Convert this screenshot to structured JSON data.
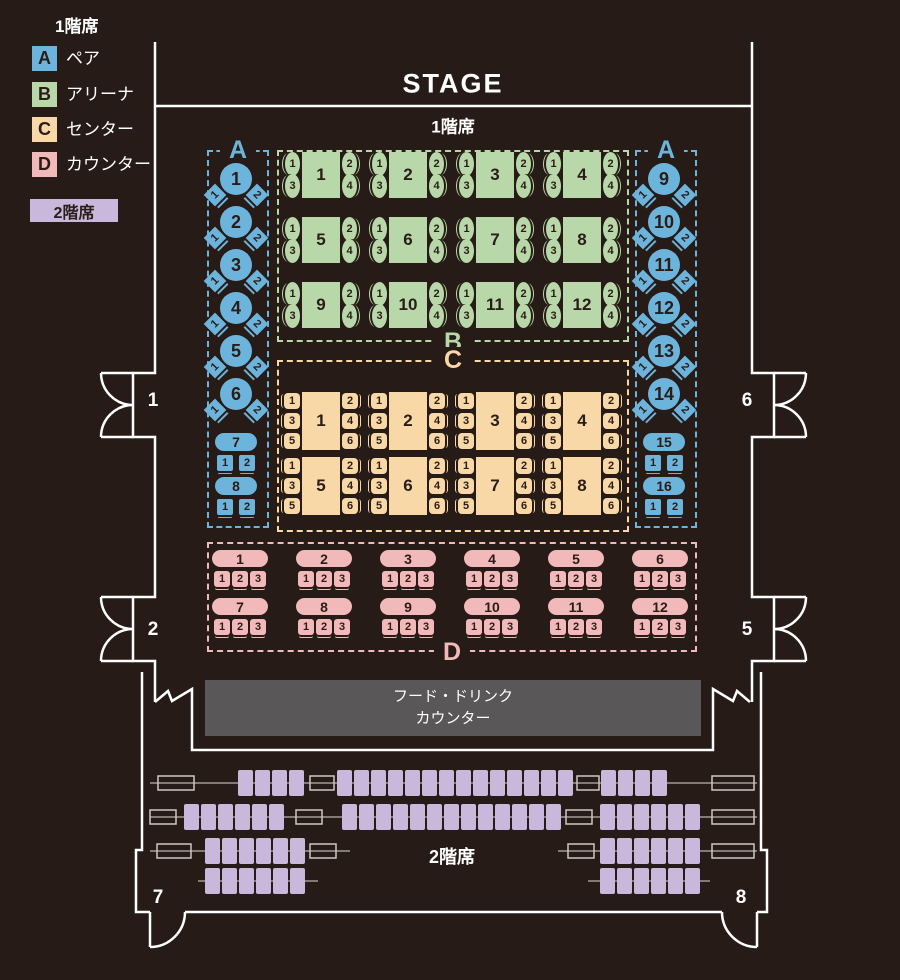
{
  "colors": {
    "bg": "#261b16",
    "blue": "#6db4dc",
    "green": "#b9d8a9",
    "orange": "#f8d8a6",
    "pink": "#f2b9ba",
    "purple": "#c9b7dc",
    "counter_gray": "#595757",
    "wall": "#ffffff",
    "ink": "#2a1c16"
  },
  "legend": {
    "floor1_title": "1階席",
    "items": [
      {
        "key": "A",
        "label": "ペア"
      },
      {
        "key": "B",
        "label": "アリーナ"
      },
      {
        "key": "C",
        "label": "センター"
      },
      {
        "key": "D",
        "label": "カウンター"
      }
    ],
    "floor2_title": "2階席"
  },
  "stage_label": "STAGE",
  "floor1_label": "1階席",
  "floor2_label": "2階席",
  "counter": {
    "line1": "フード・ドリンク",
    "line2": "カウンター"
  },
  "door_labels": [
    "1",
    "2",
    "5",
    "6",
    "7",
    "8"
  ],
  "sections": {
    "a_left": {
      "label": "A",
      "round_tables": [
        {
          "n": "1",
          "seats": [
            "1",
            "2"
          ]
        },
        {
          "n": "2",
          "seats": [
            "1",
            "2"
          ]
        },
        {
          "n": "3",
          "seats": [
            "1",
            "2"
          ]
        },
        {
          "n": "4",
          "seats": [
            "1",
            "2"
          ]
        },
        {
          "n": "5",
          "seats": [
            "1",
            "2"
          ]
        },
        {
          "n": "6",
          "seats": [
            "1",
            "2"
          ]
        }
      ],
      "pill_tables": [
        {
          "n": "7",
          "seats": [
            "1",
            "2"
          ]
        },
        {
          "n": "8",
          "seats": [
            "1",
            "2"
          ]
        }
      ]
    },
    "a_right": {
      "label": "A",
      "round_tables": [
        {
          "n": "9",
          "seats": [
            "1",
            "2"
          ]
        },
        {
          "n": "10",
          "seats": [
            "1",
            "2"
          ]
        },
        {
          "n": "11",
          "seats": [
            "1",
            "2"
          ]
        },
        {
          "n": "12",
          "seats": [
            "1",
            "2"
          ]
        },
        {
          "n": "13",
          "seats": [
            "1",
            "2"
          ]
        },
        {
          "n": "14",
          "seats": [
            "1",
            "2"
          ]
        }
      ],
      "pill_tables": [
        {
          "n": "15",
          "seats": [
            "1",
            "2"
          ]
        },
        {
          "n": "16",
          "seats": [
            "1",
            "2"
          ]
        }
      ]
    },
    "b": {
      "label": "B",
      "tables": [
        {
          "n": "1",
          "seats": [
            "1",
            "2",
            "3",
            "4"
          ]
        },
        {
          "n": "2",
          "seats": [
            "1",
            "2",
            "3",
            "4"
          ]
        },
        {
          "n": "3",
          "seats": [
            "1",
            "2",
            "3",
            "4"
          ]
        },
        {
          "n": "4",
          "seats": [
            "1",
            "2",
            "3",
            "4"
          ]
        },
        {
          "n": "5",
          "seats": [
            "1",
            "2",
            "3",
            "4"
          ]
        },
        {
          "n": "6",
          "seats": [
            "1",
            "2",
            "3",
            "4"
          ]
        },
        {
          "n": "7",
          "seats": [
            "1",
            "2",
            "3",
            "4"
          ]
        },
        {
          "n": "8",
          "seats": [
            "1",
            "2",
            "3",
            "4"
          ]
        },
        {
          "n": "9",
          "seats": [
            "1",
            "2",
            "3",
            "4"
          ]
        },
        {
          "n": "10",
          "seats": [
            "1",
            "2",
            "3",
            "4"
          ]
        },
        {
          "n": "11",
          "seats": [
            "1",
            "2",
            "3",
            "4"
          ]
        },
        {
          "n": "12",
          "seats": [
            "1",
            "2",
            "3",
            "4"
          ]
        }
      ]
    },
    "c": {
      "label": "C",
      "tables": [
        {
          "n": "1",
          "seats": [
            "1",
            "2",
            "3",
            "4",
            "5",
            "6"
          ]
        },
        {
          "n": "2",
          "seats": [
            "1",
            "2",
            "3",
            "4",
            "5",
            "6"
          ]
        },
        {
          "n": "3",
          "seats": [
            "1",
            "2",
            "3",
            "4",
            "5",
            "6"
          ]
        },
        {
          "n": "4",
          "seats": [
            "1",
            "2",
            "3",
            "4",
            "5",
            "6"
          ]
        },
        {
          "n": "5",
          "seats": [
            "1",
            "2",
            "3",
            "4",
            "5",
            "6"
          ]
        },
        {
          "n": "6",
          "seats": [
            "1",
            "2",
            "3",
            "4",
            "5",
            "6"
          ]
        },
        {
          "n": "7",
          "seats": [
            "1",
            "2",
            "3",
            "4",
            "5",
            "6"
          ]
        },
        {
          "n": "8",
          "seats": [
            "1",
            "2",
            "3",
            "4",
            "5",
            "6"
          ]
        }
      ]
    },
    "d": {
      "label": "D",
      "tables": [
        {
          "n": "1",
          "seats": [
            "1",
            "2",
            "3"
          ]
        },
        {
          "n": "2",
          "seats": [
            "1",
            "2",
            "3"
          ]
        },
        {
          "n": "3",
          "seats": [
            "1",
            "2",
            "3"
          ]
        },
        {
          "n": "4",
          "seats": [
            "1",
            "2",
            "3"
          ]
        },
        {
          "n": "5",
          "seats": [
            "1",
            "2",
            "3"
          ]
        },
        {
          "n": "6",
          "seats": [
            "1",
            "2",
            "3"
          ]
        },
        {
          "n": "7",
          "seats": [
            "1",
            "2",
            "3"
          ]
        },
        {
          "n": "8",
          "seats": [
            "1",
            "2",
            "3"
          ]
        },
        {
          "n": "9",
          "seats": [
            "1",
            "2",
            "3"
          ]
        },
        {
          "n": "10",
          "seats": [
            "1",
            "2",
            "3"
          ]
        },
        {
          "n": "11",
          "seats": [
            "1",
            "2",
            "3"
          ]
        },
        {
          "n": "12",
          "seats": [
            "1",
            "2",
            "3"
          ]
        }
      ]
    }
  },
  "floor2": {
    "rows": [
      [
        4,
        14,
        4
      ],
      [
        6,
        13,
        6
      ],
      [
        6,
        6
      ],
      [
        6,
        6
      ]
    ]
  }
}
